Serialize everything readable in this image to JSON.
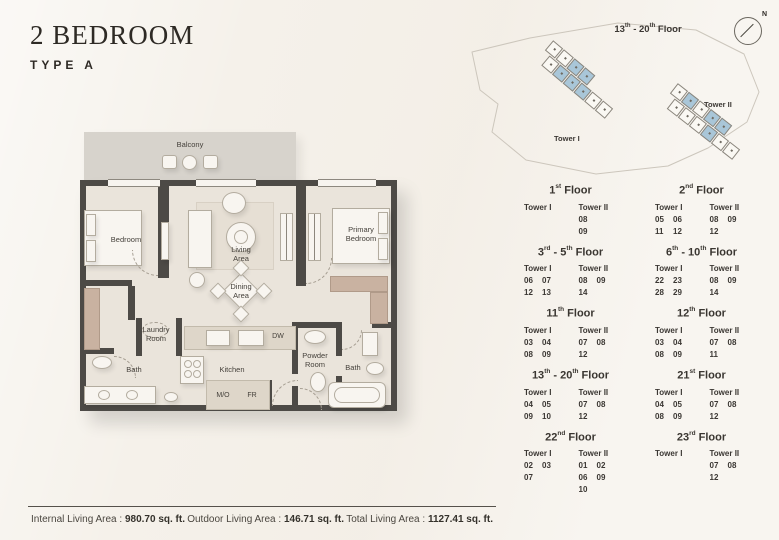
{
  "header": {
    "title": "2 BEDROOM",
    "subtitle": "TYPE A"
  },
  "plan": {
    "balcony": "Balcony",
    "bedroom": "Bedroom",
    "living_area": "Living Area",
    "dining_area": "Dining Area",
    "primary_bedroom": "Primary Bedroom",
    "laundry_room": "Laundry Room",
    "bath_left": "Bath",
    "kitchen": "Kitchen",
    "dw": "DW",
    "mo": "M/O",
    "fr": "FR",
    "powder_room": "Powder Room",
    "bath_right": "Bath"
  },
  "siteplan": {
    "floor_label": [
      {
        "t": "13"
      },
      {
        "t": "th",
        "sup": true
      },
      {
        "t": " - 20"
      },
      {
        "t": "th",
        "sup": true
      },
      {
        "t": " Floor"
      }
    ],
    "north_label": "N",
    "highlight_color": "#a9c6d8",
    "towers": [
      {
        "name": "Tower I",
        "rows": [
          [
            0,
            0,
            1,
            1
          ],
          [
            0,
            1,
            1,
            1,
            0,
            0
          ]
        ]
      },
      {
        "name": "Tower II",
        "rows": [
          [
            0,
            1,
            0,
            1,
            1
          ],
          [
            0,
            0,
            0,
            1,
            0,
            0
          ]
        ]
      }
    ]
  },
  "tables": {
    "floors": [
      {
        "title": [
          {
            "t": "1"
          },
          {
            "t": "st",
            "sup": true
          },
          {
            "t": " Floor"
          }
        ],
        "towers": [
          {
            "name": "Tower I",
            "rows": []
          },
          {
            "name": "Tower II",
            "rows": [
              [
                "08"
              ],
              [
                "09"
              ]
            ]
          }
        ]
      },
      {
        "title": [
          {
            "t": "2"
          },
          {
            "t": "nd",
            "sup": true
          },
          {
            "t": " Floor"
          }
        ],
        "towers": [
          {
            "name": "Tower I",
            "rows": [
              [
                "05",
                "06"
              ],
              [
                "11",
                "12"
              ]
            ]
          },
          {
            "name": "Tower II",
            "rows": [
              [
                "08",
                "09"
              ],
              [
                "12"
              ]
            ]
          }
        ]
      },
      {
        "title": [
          {
            "t": "3"
          },
          {
            "t": "rd",
            "sup": true
          },
          {
            "t": " - 5"
          },
          {
            "t": "th",
            "sup": true
          },
          {
            "t": " Floor"
          }
        ],
        "towers": [
          {
            "name": "Tower I",
            "rows": [
              [
                "06",
                "07"
              ],
              [
                "12",
                "13"
              ]
            ]
          },
          {
            "name": "Tower II",
            "rows": [
              [
                "08",
                "09"
              ],
              [
                "14"
              ]
            ]
          }
        ]
      },
      {
        "title": [
          {
            "t": "6"
          },
          {
            "t": "th",
            "sup": true
          },
          {
            "t": " - 10"
          },
          {
            "t": "th",
            "sup": true
          },
          {
            "t": " Floor"
          }
        ],
        "towers": [
          {
            "name": "Tower I",
            "rows": [
              [
                "22",
                "23"
              ],
              [
                "28",
                "29"
              ]
            ]
          },
          {
            "name": "Tower II",
            "rows": [
              [
                "08",
                "09"
              ],
              [
                "14"
              ]
            ]
          }
        ]
      },
      {
        "title": [
          {
            "t": "11"
          },
          {
            "t": "th",
            "sup": true
          },
          {
            "t": " Floor"
          }
        ],
        "towers": [
          {
            "name": "Tower I",
            "rows": [
              [
                "03",
                "04"
              ],
              [
                "08",
                "09"
              ]
            ]
          },
          {
            "name": "Tower II",
            "rows": [
              [
                "07",
                "08"
              ],
              [
                "12"
              ]
            ]
          }
        ]
      },
      {
        "title": [
          {
            "t": "12"
          },
          {
            "t": "th",
            "sup": true
          },
          {
            "t": " Floor"
          }
        ],
        "towers": [
          {
            "name": "Tower I",
            "rows": [
              [
                "03",
                "04"
              ],
              [
                "08",
                "09"
              ]
            ]
          },
          {
            "name": "Tower II",
            "rows": [
              [
                "07",
                "08"
              ],
              [
                "11"
              ]
            ]
          }
        ]
      },
      {
        "title": [
          {
            "t": "13"
          },
          {
            "t": "th",
            "sup": true
          },
          {
            "t": " - 20"
          },
          {
            "t": "th",
            "sup": true
          },
          {
            "t": " Floor"
          }
        ],
        "towers": [
          {
            "name": "Tower I",
            "rows": [
              [
                "04",
                "05"
              ],
              [
                "09",
                "10"
              ]
            ]
          },
          {
            "name": "Tower II",
            "rows": [
              [
                "07",
                "08"
              ],
              [
                "12"
              ]
            ]
          }
        ]
      },
      {
        "title": [
          {
            "t": "21"
          },
          {
            "t": "st",
            "sup": true
          },
          {
            "t": " Floor"
          }
        ],
        "towers": [
          {
            "name": "Tower I",
            "rows": [
              [
                "04",
                "05"
              ],
              [
                "08",
                "09"
              ]
            ]
          },
          {
            "name": "Tower II",
            "rows": [
              [
                "07",
                "08"
              ],
              [
                "12"
              ]
            ]
          }
        ]
      },
      {
        "title": [
          {
            "t": "22"
          },
          {
            "t": "nd",
            "sup": true
          },
          {
            "t": " Floor"
          }
        ],
        "towers": [
          {
            "name": "Tower I",
            "rows": [
              [
                "02",
                "03"
              ],
              [
                "07"
              ]
            ]
          },
          {
            "name": "Tower II",
            "rows": [
              [
                "01",
                "02"
              ],
              [
                "06",
                "09"
              ],
              [
                "10"
              ]
            ]
          }
        ]
      },
      {
        "title": [
          {
            "t": "23"
          },
          {
            "t": "rd",
            "sup": true
          },
          {
            "t": " Floor"
          }
        ],
        "towers": [
          {
            "name": "Tower I",
            "rows": []
          },
          {
            "name": "Tower II",
            "rows": [
              [
                "07",
                "08"
              ],
              [
                "12"
              ]
            ]
          }
        ]
      }
    ]
  },
  "footer": {
    "stats": [
      {
        "label": "Internal Living Area :",
        "value": "980.70 sq. ft."
      },
      {
        "label": "Outdoor Living Area :",
        "value": "146.71 sq. ft."
      },
      {
        "label": "Total Living Area :",
        "value": "1127.41 sq. ft."
      }
    ]
  }
}
